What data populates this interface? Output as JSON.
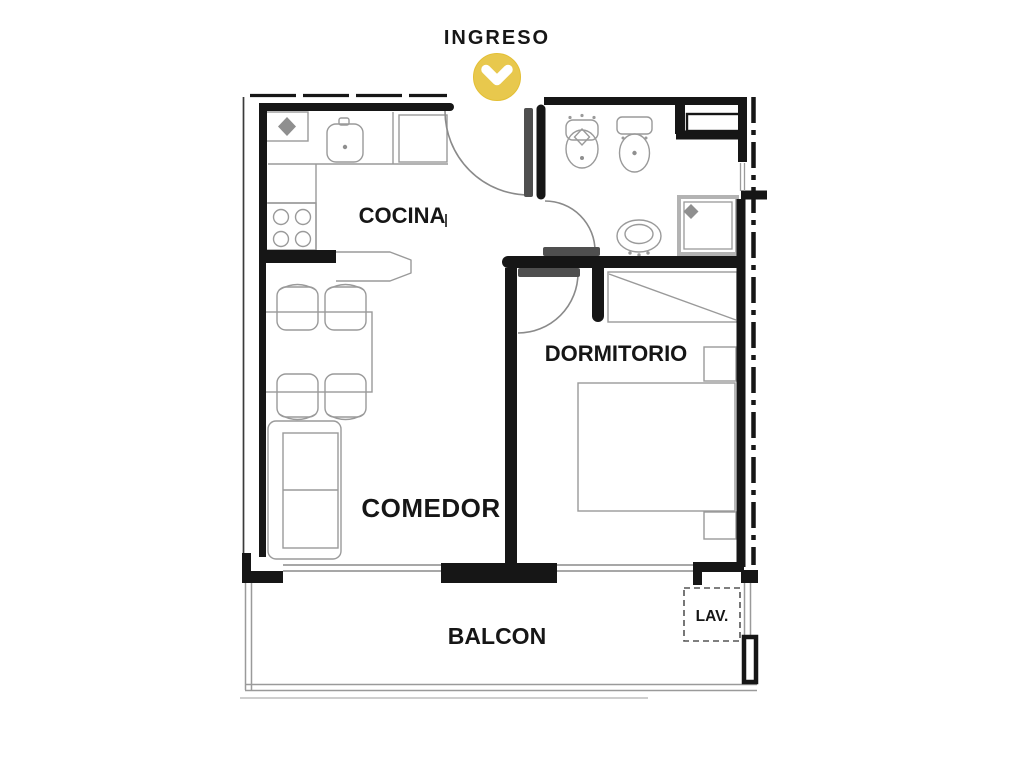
{
  "plan": {
    "entrance": {
      "label": "INGRESO",
      "icon": "chevron-down-circle-icon",
      "icon_color": "#e8c84d"
    },
    "rooms": {
      "kitchen": {
        "label": "COCINA"
      },
      "bedroom": {
        "label": "DORMITORIO"
      },
      "living_dining": {
        "label": "COMEDOR"
      },
      "balcony": {
        "label": "BALCON"
      },
      "laundry": {
        "label": "LAV."
      }
    },
    "colors": {
      "wall": "#161616",
      "furniture_line": "#9a9a9a",
      "door_leaf": "#4f4f4f",
      "label_text": "#161616",
      "entrance_text": "#3e3933",
      "accent_yellow": "#e8c84d",
      "background": "#ffffff"
    }
  }
}
